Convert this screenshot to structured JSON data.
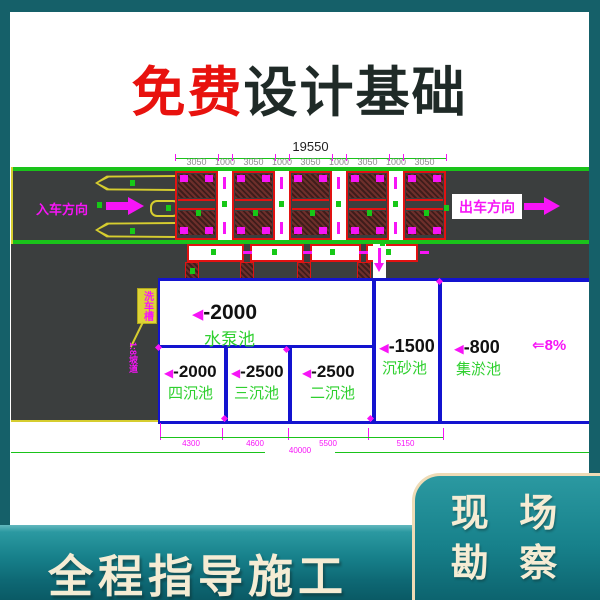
{
  "title": {
    "highlight": "免费",
    "rest": "设计基础"
  },
  "drawing": {
    "top_dimension": {
      "total": "19550",
      "segments": [
        "3050",
        "1000",
        "3050",
        "1000",
        "3050",
        "1000",
        "3050",
        "1000",
        "3050"
      ]
    },
    "road": {
      "enter": "入车方向",
      "exit": "出车方向"
    },
    "ramp_tag": "洗车槽",
    "ramp_note": "1:8坡道",
    "depth_marker": "◀",
    "slope_note": "⇐8%",
    "pools": [
      {
        "depth": "-2000",
        "name": "水泵池"
      },
      {
        "depth": "-2000",
        "name": "四沉池"
      },
      {
        "depth": "-2500",
        "name": "三沉池"
      },
      {
        "depth": "-2500",
        "name": "二沉池"
      },
      {
        "depth": "-1500",
        "name": "沉砂池"
      },
      {
        "depth": "-800",
        "name": "集淤池"
      }
    ],
    "bottom_dimension": {
      "segments": [
        "4300",
        "4600",
        "5500",
        "5150"
      ],
      "total": "40000"
    }
  },
  "footer": {
    "banner": "全程指导施工",
    "badge_line1": "现 场",
    "badge_line2": "勘 察"
  },
  "colors": {
    "page_teal": "#156069",
    "band_teal": "#17818b",
    "cream": "#f5ecd4",
    "title_red": "#e8120e",
    "cad_green": "#1ac31a",
    "cad_magenta": "#f714f7",
    "cad_blue": "#1313cf",
    "cad_red": "#e11212",
    "road_gray": "#3b3e3e",
    "mark_yellow": "#d6cd2f"
  }
}
